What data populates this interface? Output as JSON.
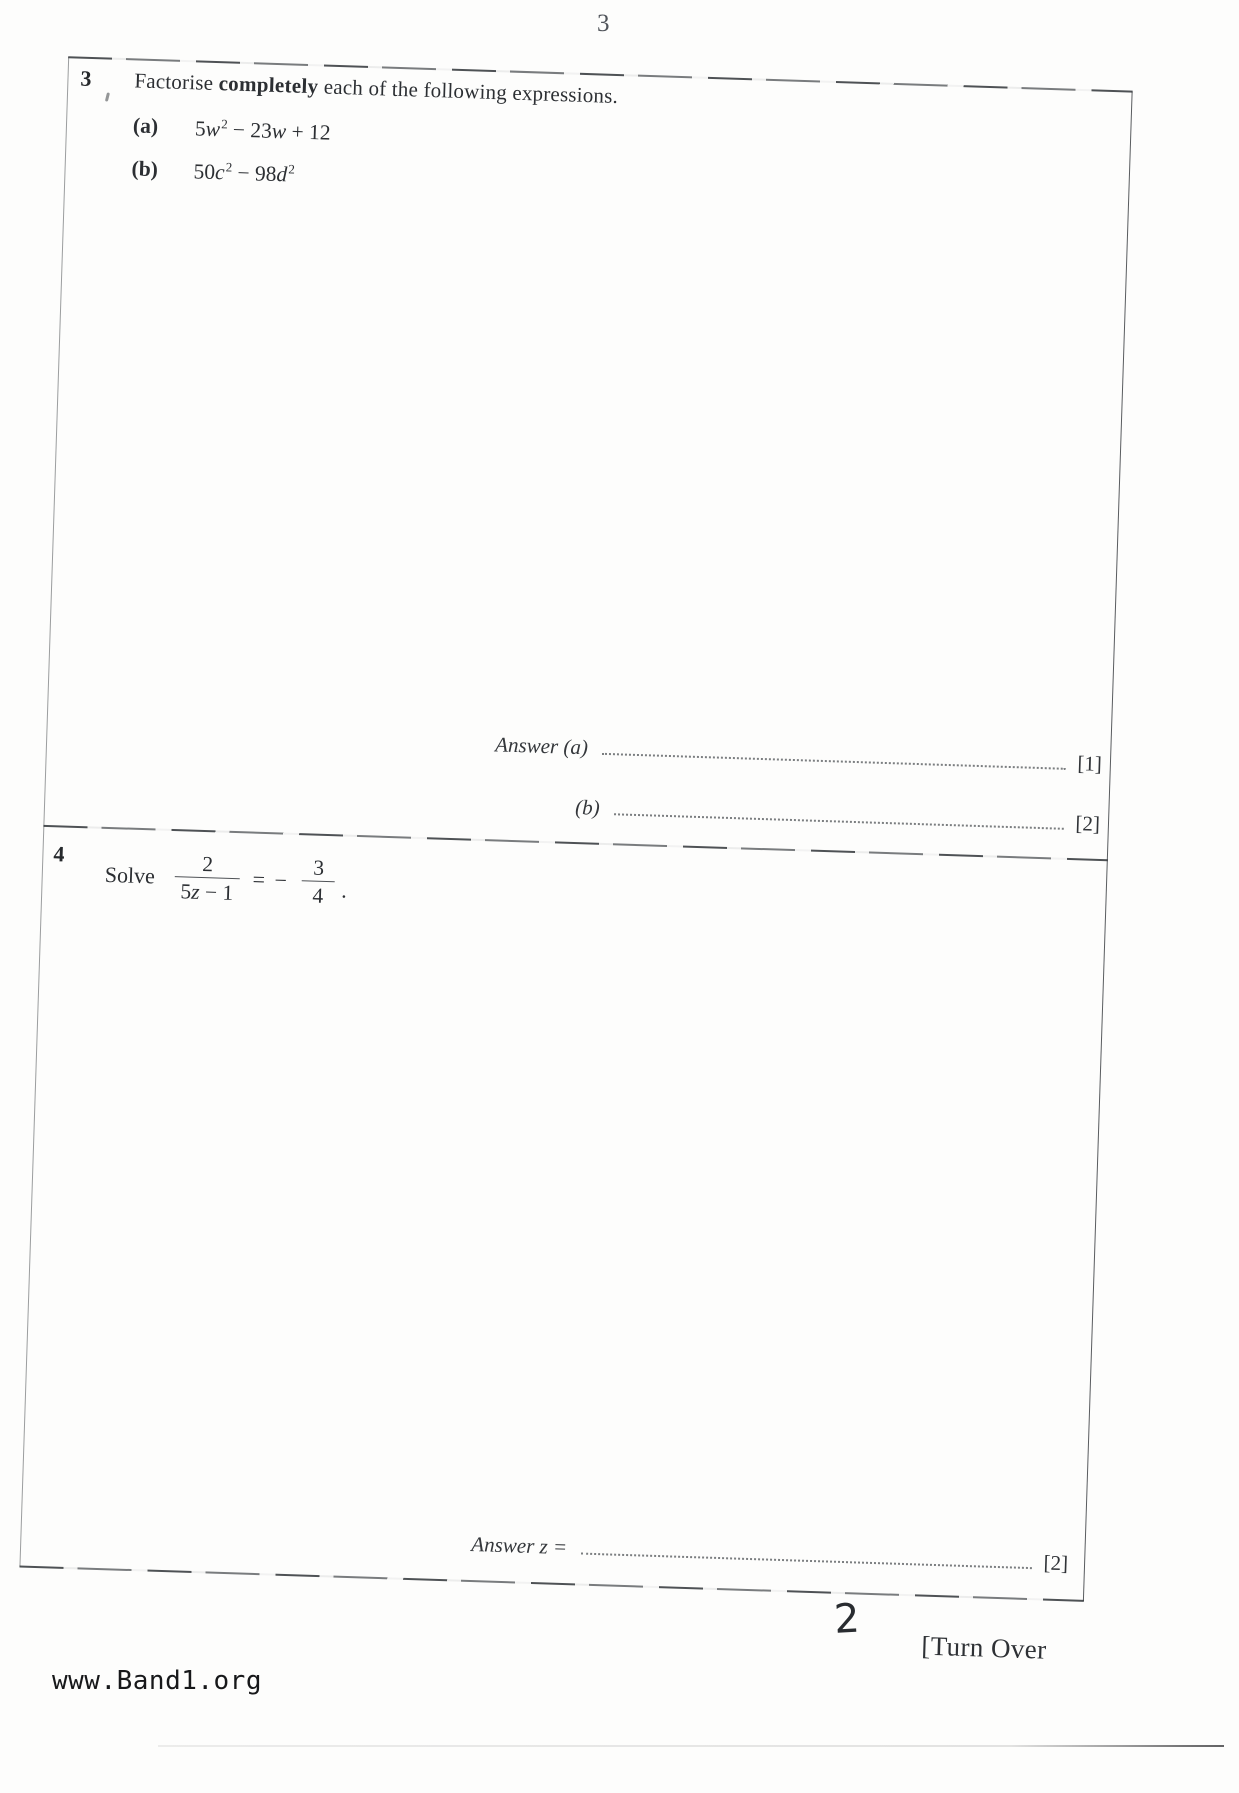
{
  "page": {
    "number": "3",
    "watermark": "www.Band1.org",
    "turn_over_label": "[Turn Over",
    "handwritten_score": "2"
  },
  "q3": {
    "number": "3",
    "prompt_runs": [
      {
        "t": "Factorise "
      },
      {
        "t": "completely",
        "s": "b"
      },
      {
        "t": " each of the following expressions."
      }
    ],
    "parts": [
      {
        "label": "(a)",
        "expr_runs": [
          {
            "t": "5"
          },
          {
            "t": "w",
            "s": "v"
          },
          {
            "t": "2",
            "s": "sup"
          },
          {
            "t": " − 23"
          },
          {
            "t": "w",
            "s": "v"
          },
          {
            "t": " + 12"
          }
        ]
      },
      {
        "label": "(b)",
        "expr_runs": [
          {
            "t": "50"
          },
          {
            "t": "c",
            "s": "v"
          },
          {
            "t": "2",
            "s": "sup"
          },
          {
            "t": " − 98"
          },
          {
            "t": "d",
            "s": "v"
          },
          {
            "t": "2",
            "s": "sup"
          }
        ]
      }
    ],
    "answer_a": {
      "label": "Answer (a)",
      "marks": "[1]"
    },
    "answer_b": {
      "label": "(b)",
      "marks": "[2]"
    }
  },
  "q4": {
    "number": "4",
    "verb": "Solve",
    "lhs": {
      "num": "2",
      "den_runs": [
        {
          "t": "5"
        },
        {
          "t": "z",
          "s": "v"
        },
        {
          "t": " − 1"
        }
      ]
    },
    "equals": "= −",
    "rhs": {
      "num": "3",
      "den": "4"
    },
    "terminator": ".",
    "answer": {
      "label": "Answer z =",
      "marks": "[2]"
    }
  }
}
